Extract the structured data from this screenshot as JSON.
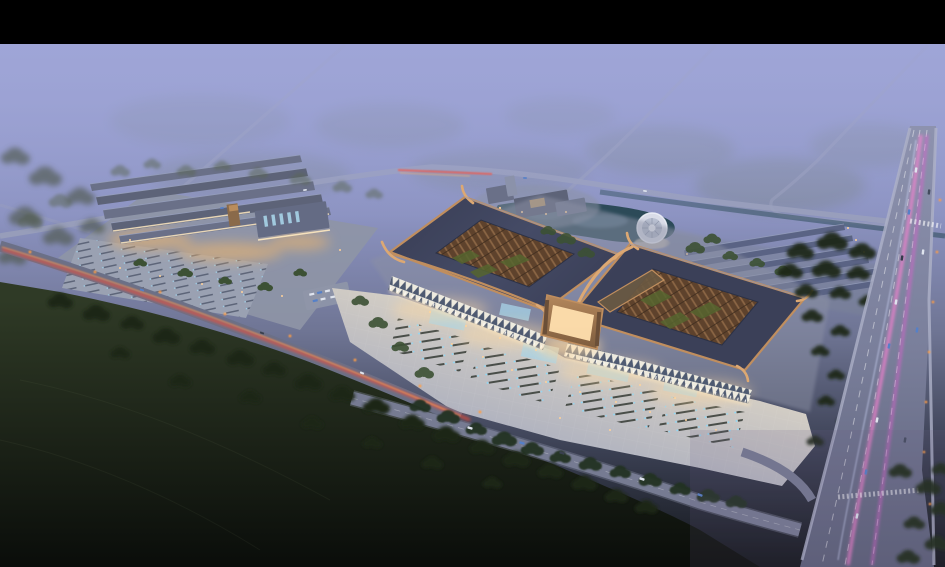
{
  "meta": {
    "type": "architectural-aerial-rendering",
    "time_of_day": "dusk",
    "alt": "Bird's-eye dusk rendering of a market/exhibition campus: two large curved-eave halls with open lattice roof courtyards, a glowing entrance gate, bright front parking plaza, a secondary warehouse-market complex at left, pond with circular fountain plaza, dormitory rows, misty farm fields with thin roads above, a dark tree-lined field in the foreground, a diagonal road with red tail-light trails and a wide arterial road with pink light trails at right, letterboxed with a black bar at top."
  },
  "palette": {
    "black": "#000000",
    "sky_top": "#9ba2d4",
    "sky_mid": "#8b92c0",
    "sky_low": "#6f7594",
    "dusk": "#3a3f52",
    "night": "#121519",
    "mist": "#a0a6d8",
    "field_green": "#6f7d6a",
    "forest_dim": "#4a5243",
    "tree_mid": "#32442c",
    "tree_dark": "#1c2718",
    "fg_top": "#2f3a26",
    "fg_bot": "#0a0d0a",
    "road_light": "#9aa0ba",
    "road_mid": "#767b92",
    "road_dark": "#6b7087",
    "sidewalk": "#aeb2c8",
    "trail_red": "#ff4a2e",
    "trail_amber": "#ffae57",
    "street_orange": "#ff9d45",
    "trail_pink": "#ff7fd4",
    "trail_magenta": "#dc5ece",
    "trail_white": "#d6ddff",
    "water_deep": "#2c4a58",
    "water_light": "#6d8aa0",
    "fountain_light": "#d9dce8",
    "roof_slate": "#454b66",
    "roof_slate_dark": "#3b4058",
    "roof_copper": "#c08e5e",
    "eave_light": "#dca873",
    "lattice_bg": "#5e422c",
    "lattice_line": "#8a6544",
    "lattice_green": "#56652f",
    "facade_white": "#f2efe3",
    "glass_blue": "#33415e",
    "glow_warm": "#ffd9a0",
    "glow_strong": "#ffe9c0",
    "window_warm": "#f5b86a",
    "plaza_warm": "#d5cfc5",
    "plaza_cool": "#a2a8bd",
    "stall_dark": "#3c423c",
    "stall_blue": "#86dcff",
    "bldg_grey": "#6a7088",
    "bldg_grey2": "#5d6378",
    "row_roof": "#5a6384",
    "row_hi": "#97a0bd",
    "ground_site": "#8e95a6",
    "lot_base": "#9aa1b2",
    "gate_bronze": "#b4875c",
    "gate_glow": "#ffdfae",
    "skylight_blue": "#a8d4e8",
    "car_blue": "#5580c8",
    "car_white": "#dfe4ee"
  },
  "scene": {
    "regions": [
      "top-letterbox-bar",
      "misty-farm-fields",
      "field-roads",
      "main-top-road",
      "pond-and-fountain-plaza",
      "office-building-cluster",
      "left-market-complex",
      "dormitory-rows",
      "main-hall-left",
      "main-hall-right",
      "entrance-gate",
      "front-parking-plaza",
      "boulevard-road",
      "diagonal-road-red-trail",
      "arterial-road-pink-trails",
      "foreground-dark-fields"
    ]
  }
}
